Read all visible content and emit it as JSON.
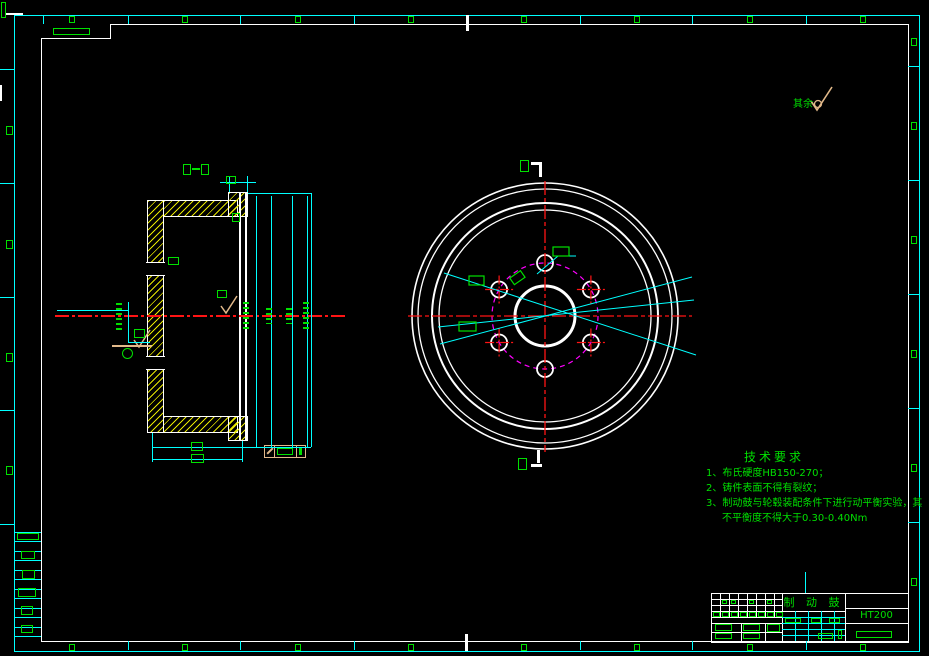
{
  "drawing": {
    "tech_requirements": {
      "title": "技术要求",
      "lines": [
        "1、布氏硬度HB150-270；",
        "2、铸件表面不得有裂纹；",
        "3、制动鼓与轮毂装配条件下进行动平衡实验，其",
        "不平衡度不得大于0.30-0.40Nm"
      ]
    },
    "surface_note": {
      "text": "其余"
    },
    "title_block": {
      "part_name": "制 动 鼓",
      "material": "HT200"
    },
    "colors": {
      "line_white": "#ffffff",
      "dimension_cyan": "#00ffff",
      "annotation_green": "#00e000",
      "centerline_red": "#ff1414",
      "bolt_circle_magenta": "#ff00ff",
      "hatch_yellow": "#e6e600",
      "symbol_tan": "#e2b98a",
      "background": "#000000"
    }
  }
}
